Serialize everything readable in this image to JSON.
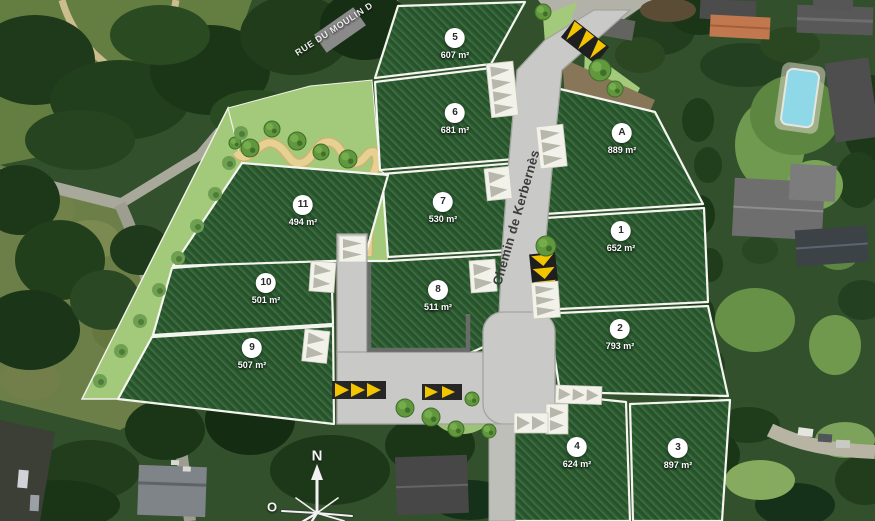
{
  "streets": {
    "main": "Chemin de Kerbernès",
    "secondary": "RUE DU MOULIN D"
  },
  "compass": {
    "north": "N",
    "west": "O"
  },
  "lots": [
    {
      "id": "5",
      "area": "607 m²",
      "x": 455,
      "y": 44
    },
    {
      "id": "6",
      "area": "681 m²",
      "x": 455,
      "y": 119
    },
    {
      "id": "7",
      "area": "530 m²",
      "x": 443,
      "y": 208
    },
    {
      "id": "8",
      "area": "511 m²",
      "x": 438,
      "y": 296
    },
    {
      "id": "A",
      "area": "889 m²",
      "x": 622,
      "y": 139
    },
    {
      "id": "1",
      "area": "652 m²",
      "x": 621,
      "y": 237
    },
    {
      "id": "2",
      "area": "793 m²",
      "x": 620,
      "y": 335
    },
    {
      "id": "3",
      "area": "897 m²",
      "x": 678,
      "y": 454
    },
    {
      "id": "4",
      "area": "624 m²",
      "x": 577,
      "y": 453
    },
    {
      "id": "9",
      "area": "507 m²",
      "x": 252,
      "y": 354
    },
    {
      "id": "10",
      "area": "501 m²",
      "x": 266,
      "y": 289
    },
    {
      "id": "11",
      "area": "494 m²",
      "x": 303,
      "y": 211
    }
  ],
  "colors": {
    "parcel_green": "#2f5e33",
    "buffer_green": "#a3c97a",
    "road_gray": "#c9c9c7",
    "path_tan": "#e6d193",
    "crossing_yellow": "#f2c500"
  }
}
